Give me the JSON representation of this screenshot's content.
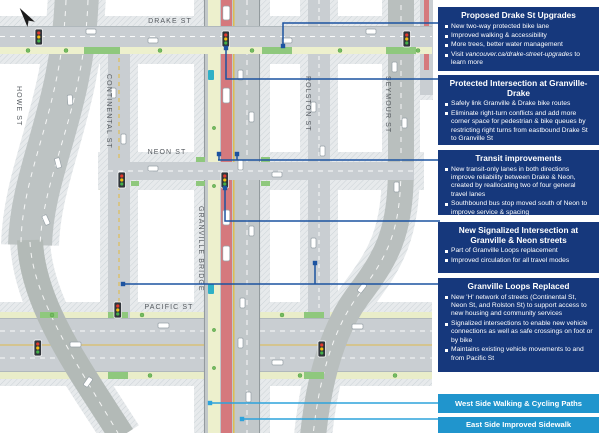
{
  "map": {
    "labels": {
      "drake": "DRAKE ST",
      "howe": "HOWE ST",
      "continental": "CONTINENTAL ST",
      "neon": "NEON ST",
      "granville": "GRANVILLE BRIDGE",
      "rolston": "ROLSTON ST",
      "seymour": "SEYMOUR ST",
      "pacific": "PACIFIC ST"
    },
    "icons": {
      "north_arrow": "north-arrow",
      "traffic_signal": "traffic-signal",
      "bus_stop": "bus-stop"
    },
    "colors": {
      "transit_lane_red": "#d5797d",
      "bike_path_pale": "#edf0cd",
      "green_landscape": "#8fc87d",
      "road_gray": "#c9ced2",
      "navy_box": "#16387c",
      "light_blue_box": "#2095cd",
      "leader_navy": "#1c53a0",
      "leader_blue": "#2da3dc"
    }
  },
  "callouts": [
    {
      "title": "Proposed Drake St Upgrades",
      "bullets": [
        "New two-way protected bike lane",
        "Improved walking & accessibility",
        "More trees, better water management"
      ],
      "link_bullet": {
        "pre": "Visit ",
        "url": "vancouver.ca/drake-street-upgrades",
        "post": " to learn more"
      }
    },
    {
      "title": "Protected Intersection at Granville-Drake",
      "bullets": [
        "Safely link Granville & Drake bike routes",
        "Eliminate right-turn conflicts and add more corner space for pedestrian & bike queues by restricting right turns from eastbound Drake St to Granville St"
      ]
    },
    {
      "title": "Transit improvements",
      "bullets": [
        "New transit-only lanes in both directions improve reliability between Drake & Neon, created by reallocating two of four general travel lanes",
        "Southbound bus stop moved south of Neon to improve service & spacing"
      ]
    },
    {
      "title": "New Signalized Intersection at Granville & Neon streets",
      "bullets": [
        "Part of Granville Loops replacement",
        "Improved circulation for all travel modes"
      ]
    },
    {
      "title": "Granville Loops Replaced",
      "bullets": [
        "New 'H' network of streets (Continental St, Neon St, and Rolston St) to support access to new housing and community services",
        "Signalized intersections to enable new vehicle connections as well as safe crossings on foot or by bike",
        "Maintains existing vehicle movements to and from Pacific St"
      ]
    }
  ],
  "banners": [
    {
      "label": "West Side Walking & Cycling Paths"
    },
    {
      "label": "East Side Improved Sidewalk"
    }
  ]
}
